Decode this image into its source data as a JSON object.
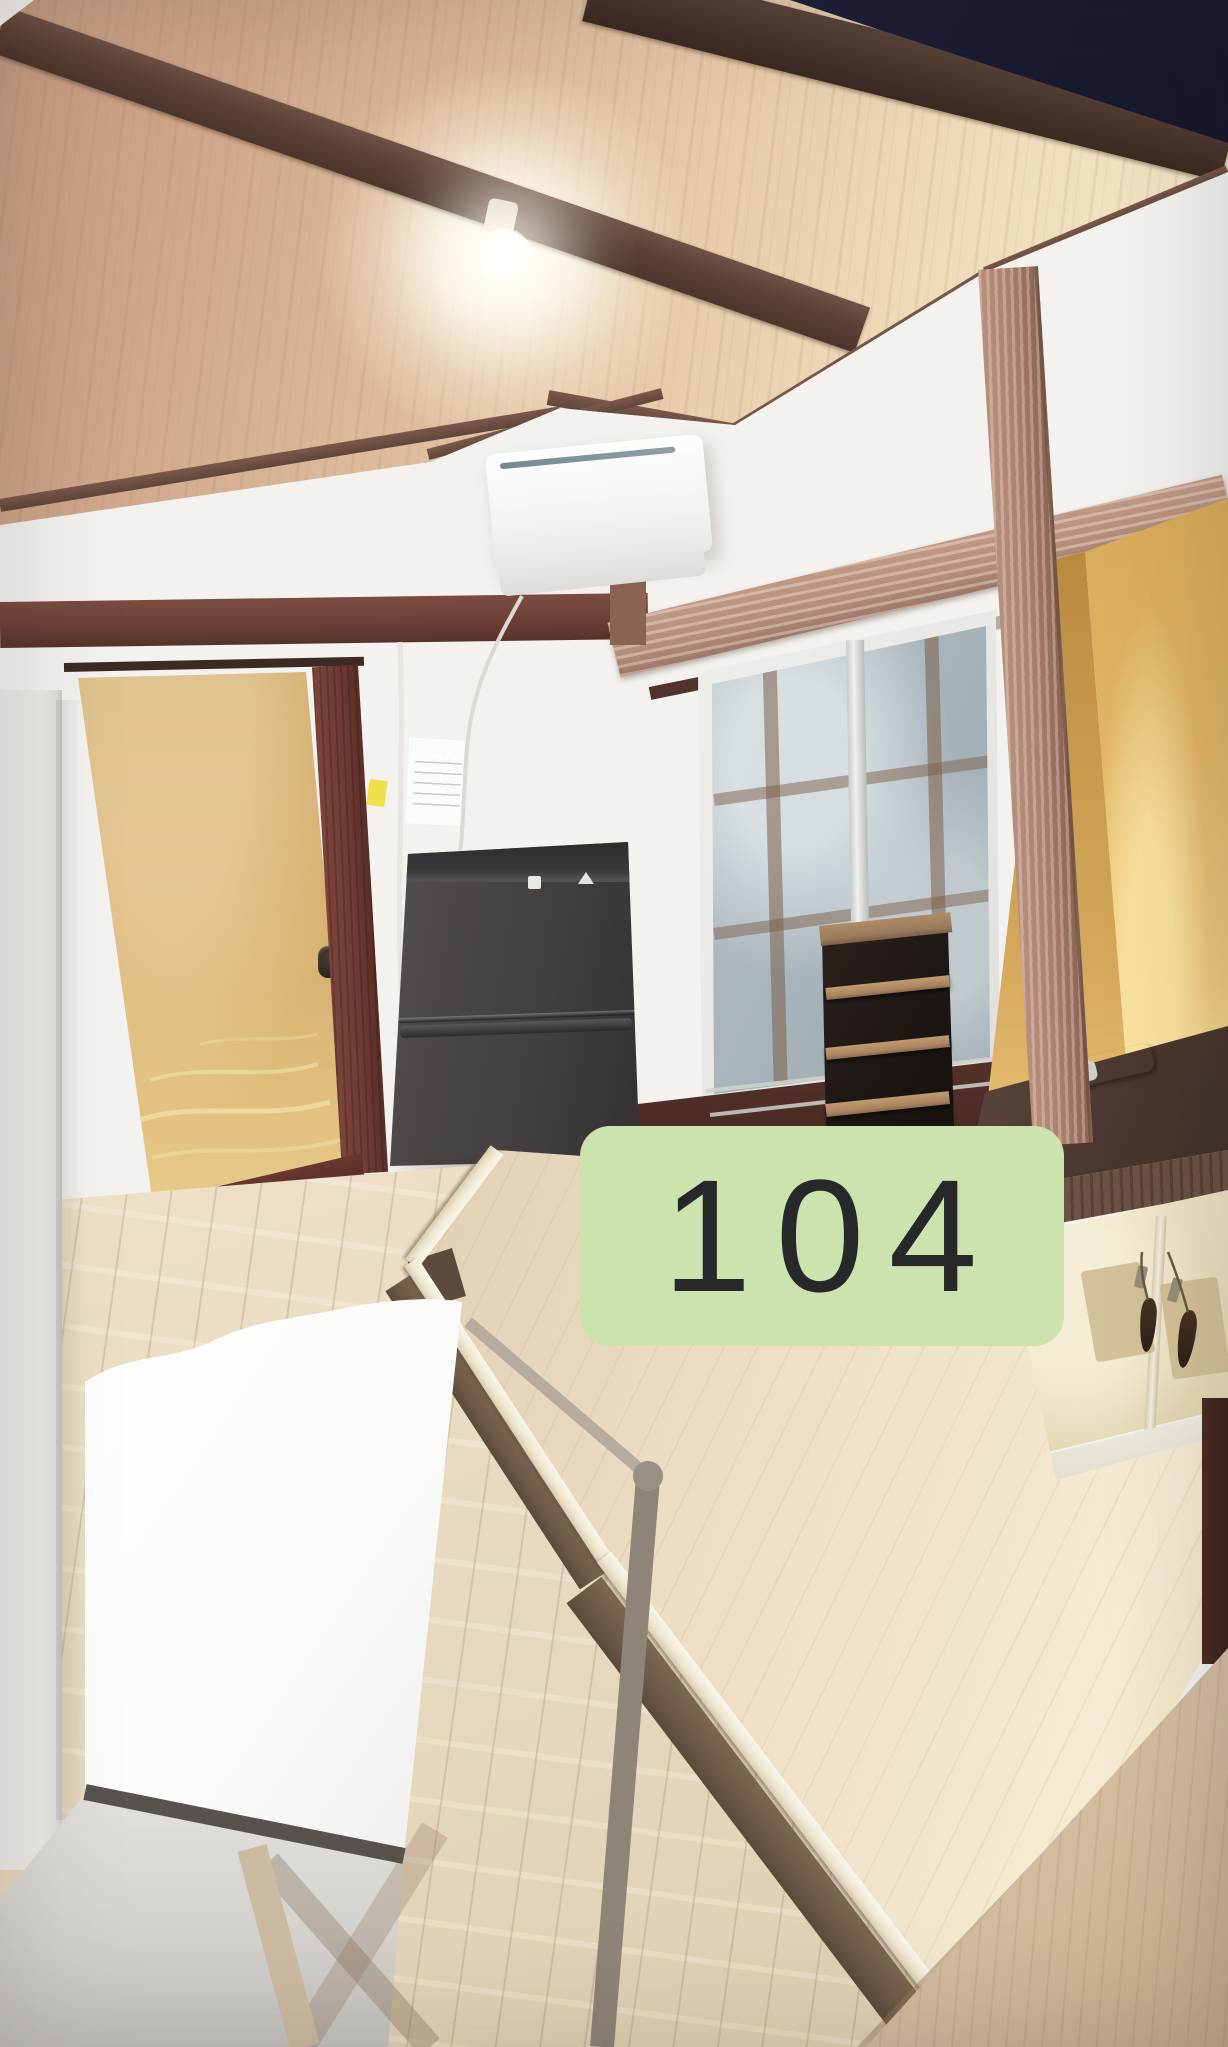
{
  "badge": {
    "label": "104"
  },
  "colors": {
    "badge-bg": "#cde3ad",
    "badge-text": "#26282a",
    "wall-white": "#f3f2ef",
    "ceiling-plywood": "#dcba9c",
    "rafter-dark": "#5c4236",
    "loft-shadow": "#20203a",
    "beam-maroon": "#6e4036",
    "beam-tan": "#b48e7b",
    "door-gold": "#d6b06c",
    "door-frame": "#6e3a33",
    "fridge-body": "#464143",
    "window-glass": "#a6b2b9",
    "alcove-mustard": "#e0b466",
    "counter-brown": "#4d3931",
    "cabinet-cream": "#e9dcba",
    "platform-wood": "#ecdcc2",
    "floor-plank": "#e7d9bf",
    "step-wood": "#d2bb9e",
    "table-white": "#fbfbfa"
  }
}
